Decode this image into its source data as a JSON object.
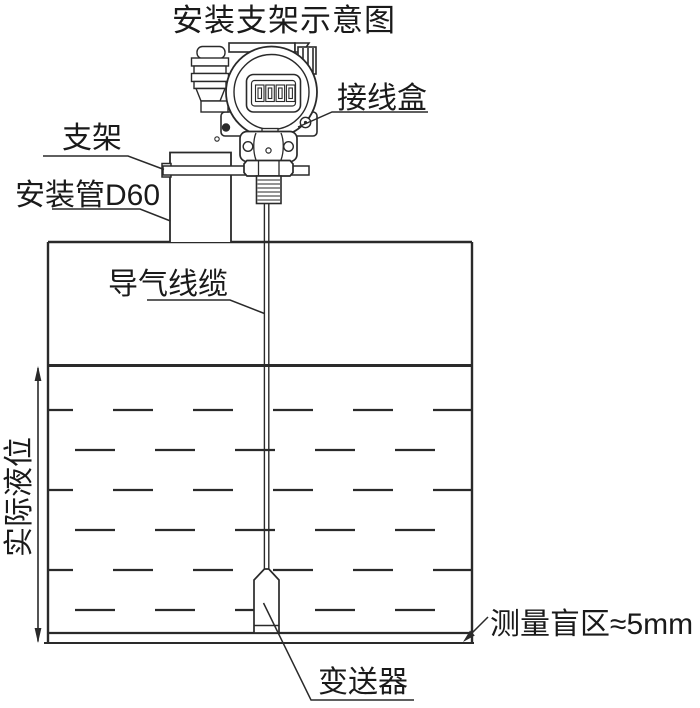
{
  "title": "安装支架示意图",
  "labels": {
    "junction_box": "接线盒",
    "bracket": "支架",
    "mounting_pipe": "安装管D60",
    "air_cable": "导气线缆",
    "actual_level": "实际液位",
    "transmitter": "变送器",
    "blind_zone": "测量盲区≈5mm"
  },
  "diagram": {
    "type": "installation-schematic",
    "elements": [
      "junction-box-head",
      "lcd-display",
      "cable-gland",
      "bracket-plate",
      "mounting-pipe-D60",
      "tank",
      "liquid-surface",
      "air-guide-cable",
      "probe-transmitter",
      "actual-level-dimension",
      "blind-zone-annotation"
    ]
  },
  "colors": {
    "line": "#2a2a2a",
    "text": "#1a1a1a",
    "background": "#ffffff"
  }
}
